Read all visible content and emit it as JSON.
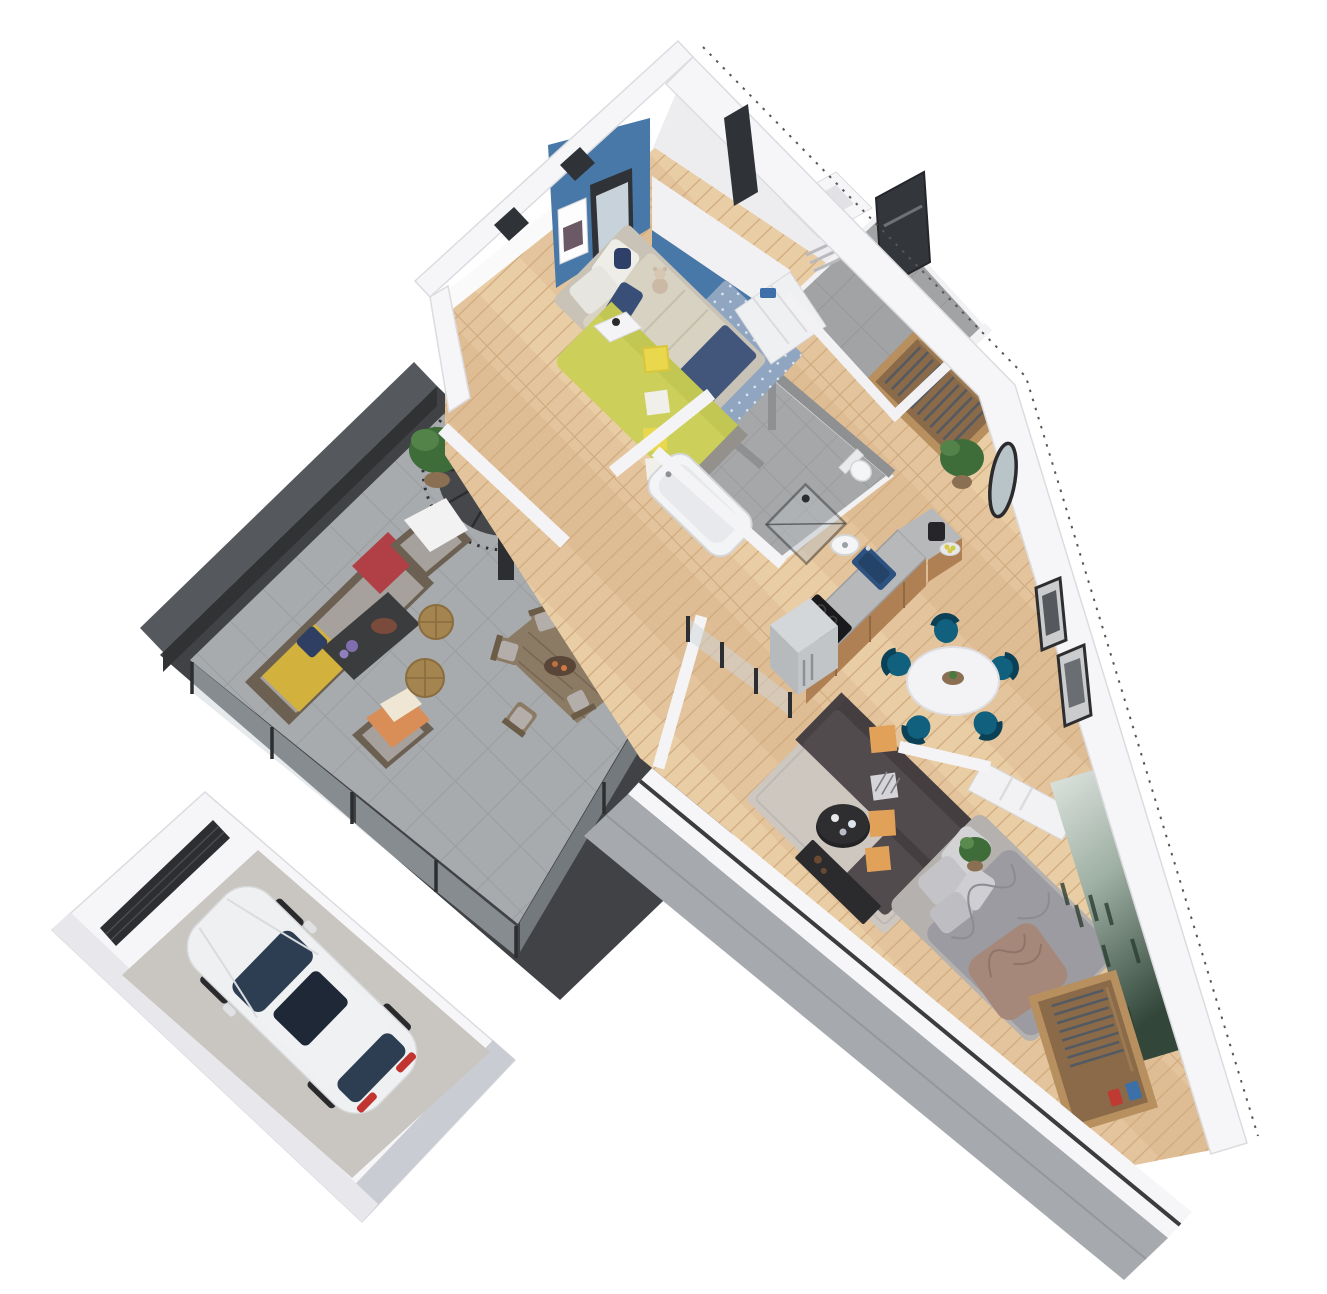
{
  "scene": {
    "title": "3D isometric cutaway floor plan of a triangular apartment with roof terrace and garage",
    "view": "axonometric top-down render, no text labels",
    "rooms": [
      {
        "id": "terrace",
        "name": "Terrace",
        "floor": "grey concrete tiles"
      },
      {
        "id": "garage",
        "name": "Garage",
        "floor": "concrete"
      },
      {
        "id": "child-bedroom",
        "name": "Child bedroom",
        "floor": "light oak"
      },
      {
        "id": "entry-hall",
        "name": "Entry hall",
        "floor": "grey tile"
      },
      {
        "id": "walk-in-wardrobe",
        "name": "Walk-in wardrobe",
        "floor": "light oak"
      },
      {
        "id": "bathroom",
        "name": "Bathroom",
        "floor": "grey tile"
      },
      {
        "id": "wc",
        "name": "WC",
        "floor": "grey tile"
      },
      {
        "id": "kitchen",
        "name": "Kitchen",
        "floor": "light oak"
      },
      {
        "id": "dining-area",
        "name": "Dining area",
        "floor": "light oak"
      },
      {
        "id": "living-room",
        "name": "Living room",
        "floor": "light oak"
      },
      {
        "id": "master-bedroom",
        "name": "Master bedroom",
        "floor": "light oak"
      }
    ],
    "furniture": {
      "terrace": [
        "wicker sofa with grey cushions",
        "yellow throw",
        "red plaid blanket",
        "two wicker armchairs",
        "dark coffee table",
        "two wicker poufs",
        "outdoor dining table with six chairs",
        "potted plants",
        "spiral staircase with landing"
      ],
      "garage": [
        "white estate car",
        "dark sectional garage door"
      ],
      "child_bedroom": [
        "single bed with beige and navy bedding",
        "yellow day-bed sofa",
        "dotted blue rug",
        "teddy bear",
        "navy backpack",
        "poster on blue accent wall",
        "white sliding wardrobe"
      ],
      "entry_hall": [
        "dark front door",
        "storage closet",
        "open oak wardrobe with hanging clothes",
        "round wall mirror",
        "fiddle-leaf plant"
      ],
      "bathroom": [
        "bathtub",
        "walk-in shower",
        "washbasin"
      ],
      "wc": [
        "toilet"
      ],
      "kitchen": [
        "L-shaped counter",
        "blue sink",
        "induction hob",
        "retro silver fridge",
        "coffee machine",
        "fruit bowl"
      ],
      "dining_area": [
        "round white table",
        "five teal velvet chairs"
      ],
      "living_room": [
        "dark grey corner sofa",
        "orange cushions",
        "checkered cushion",
        "black round coffee table",
        "grey rug",
        "low media sideboard"
      ],
      "master_bedroom": [
        "double bed with grey bedding",
        "taupe throw",
        "bedside plant",
        "foggy forest wall mural",
        "open wardrobe with clothes and boxes"
      ]
    },
    "palette": {
      "white_wall": "#f6f6f8",
      "wall_face": "#ededf0",
      "wall_edge": "#d9d9de",
      "blue_accent": "#4878a8",
      "door_dark": "#33363b",
      "window_dark": "#2f3237",
      "deck_dark": "#404245",
      "parapet": "#55585c",
      "stair_dark": "#37393c",
      "glass_pane": "#cdd5d9",
      "wicker_brown": "#6b6052",
      "cushion_gray": "#a7a19d",
      "throw_yellow": "#d2b23c",
      "plaid_red": "#b04046",
      "pouf_tan": "#a5854f",
      "outdoor_wood": "#8b7a64",
      "car_white": "#eef0f2",
      "garage_floor": "#c9c6c1",
      "garage_door": "#2c2e31",
      "counter_gray": "#b7b8ba",
      "cabinet_wood": "#b08055",
      "sink_blue": "#2d5280",
      "cooktop_black": "#1a1a1c",
      "fridge_silver": "#c2c5c8",
      "table_black": "#232325",
      "table_white": "#f3f3f5",
      "chair_teal": "#11607e",
      "rug_gray": "#cbc7c2",
      "rug_blue": "#8fa5c0",
      "daybed_yellow": "#ccd05a",
      "bed_beige": "#d8d2c2",
      "navy": "#3a4f78",
      "sofa_dark": "#514b4d",
      "pillow_orange": "#e2a159",
      "bed_gray": "#9b9ba1",
      "bed_taupe": "#a5887a",
      "wardrobe_wood": "#b8905f",
      "fascia_gray": "#a6a9ae",
      "plant_green": "#3f6d39",
      "pot_brown": "#8a6f52",
      "mirror_frame": "#2b2b2d"
    }
  }
}
